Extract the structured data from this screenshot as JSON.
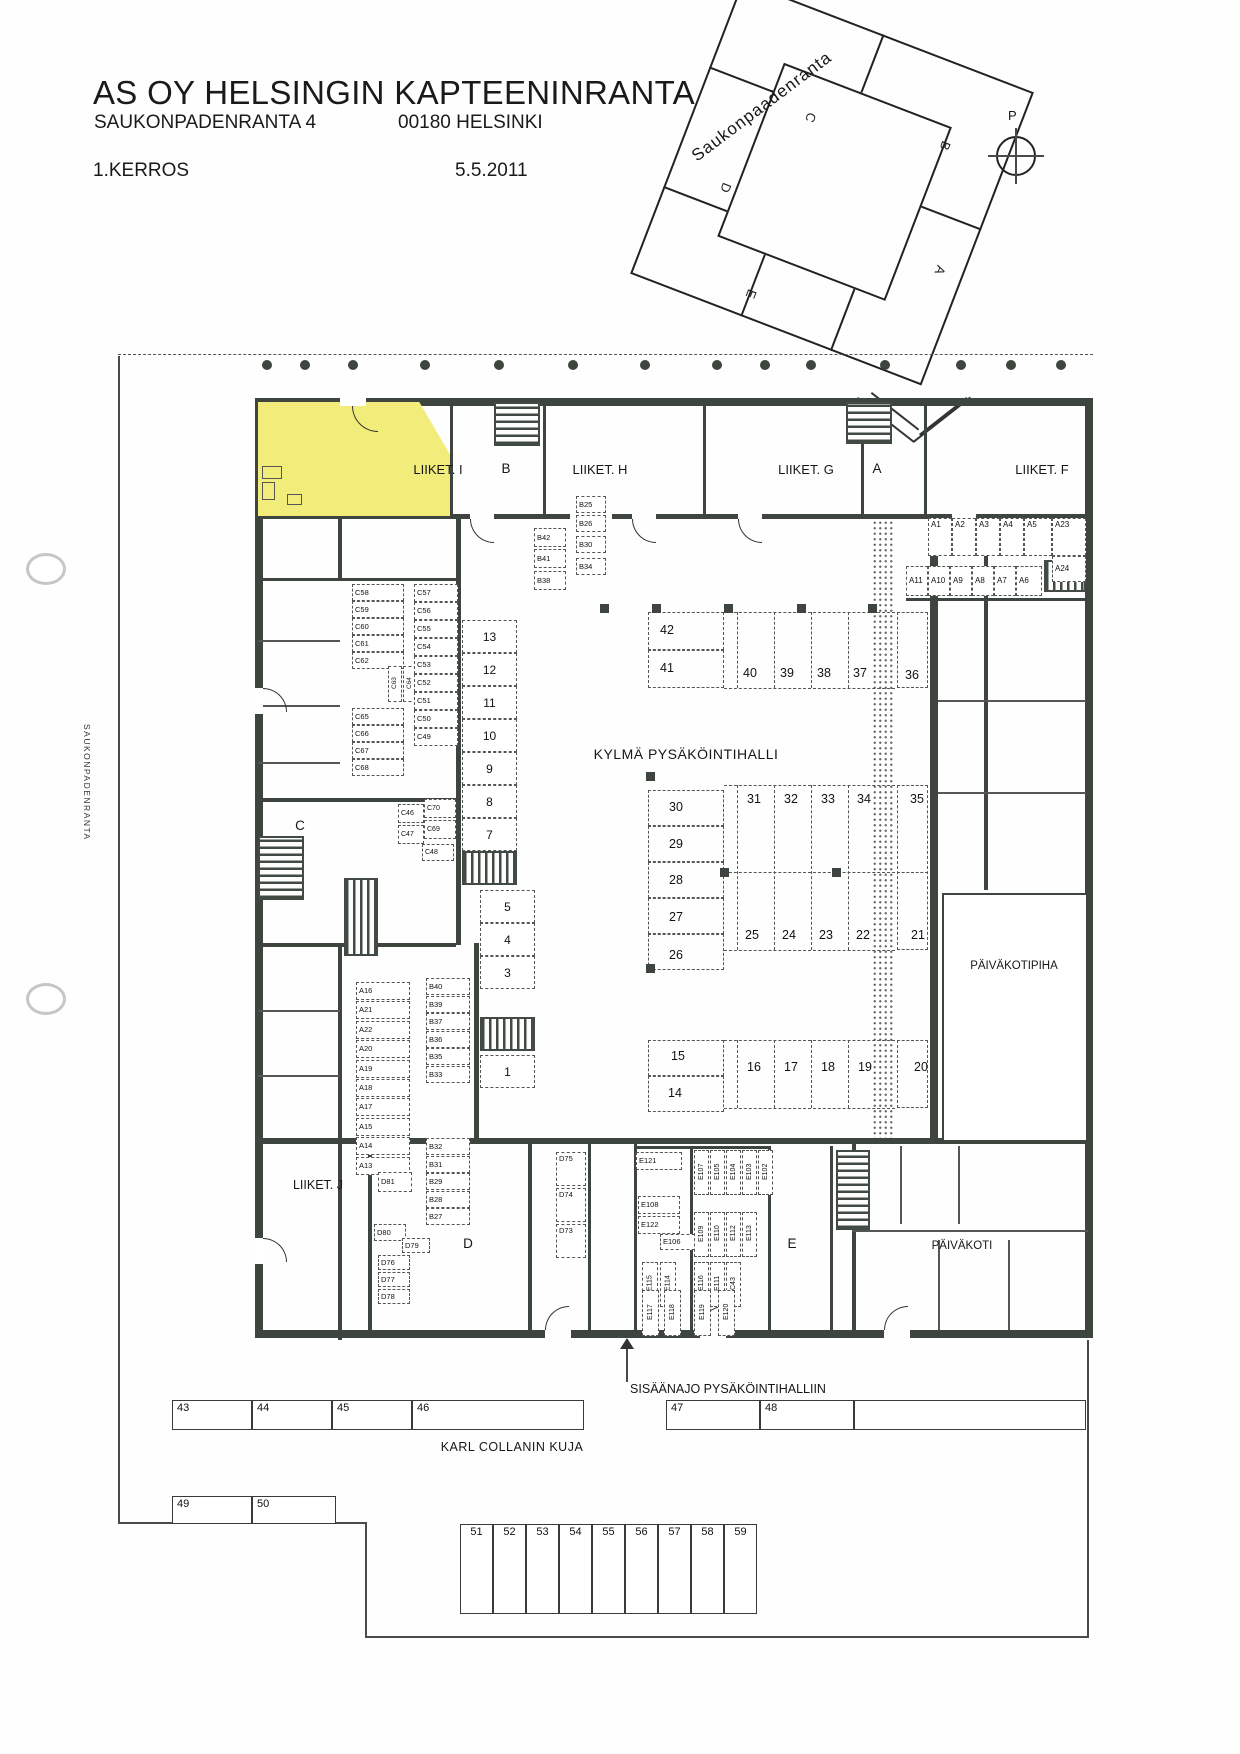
{
  "header": {
    "title": "AS OY HELSINGIN KAPTEENINRANTA",
    "address": "SAUKONPADENRANTA 4",
    "postal": "00180 HELSINKI",
    "floor": "1.KERROS",
    "date": "5.5.2011"
  },
  "site_map": {
    "street": "Saukonpaadenranta",
    "compass": "P",
    "wings": [
      "B",
      "C",
      "A",
      "D",
      "E"
    ]
  },
  "streets": {
    "west": "SAUKONPADENRANTA",
    "south": "KARL COLLANIN KUJA"
  },
  "plan": {
    "hall_label": "KYLMÄ PYSÄKÖINTIHALLI",
    "entrance_label": "SISÄÄNAJO PYSÄKÖINTIHALLIIN",
    "daycare": "PÄIVÄKOTI",
    "daycare_yard": "PÄIVÄKOTIPIHA",
    "retail_i": "LIIKET. I",
    "retail_h": "LIIKET. H",
    "retail_g": "LIIKET. G",
    "retail_f": "LIIKET. F",
    "retail_j": "LIIKET. J",
    "sec_a": "A",
    "sec_b": "B",
    "sec_c": "C",
    "sec_d": "D",
    "sec_e": "E"
  },
  "groups": {
    "c_left": [
      "C58",
      "C59",
      "C60",
      "C61",
      "C62"
    ],
    "c_rot": [
      "C63",
      "C64"
    ],
    "c_left2": [
      "C65",
      "C66",
      "C67",
      "C68"
    ],
    "c_right": [
      "C57",
      "C56",
      "C55",
      "C54",
      "C53",
      "C52",
      "C51",
      "C50",
      "C49"
    ],
    "c_small_left": [
      "C46",
      "C47"
    ],
    "c_small_48": [
      "C48"
    ],
    "c_small_right": [
      "C70",
      "C69"
    ],
    "stall_col": [
      "13",
      "12",
      "11",
      "10",
      "9",
      "8",
      "7"
    ],
    "stall_col2": [
      "5",
      "4",
      "3"
    ],
    "stall_col3": [
      "1"
    ],
    "p_42_41": [
      "42",
      "41"
    ],
    "p_top_row": [
      "40",
      "39",
      "38",
      "37"
    ],
    "p_36": [
      "36"
    ],
    "p_mid_col": [
      "30",
      "29",
      "28",
      "27",
      "26"
    ],
    "p_row31": [
      "31",
      "32",
      "33",
      "34"
    ],
    "p_35": [
      "35"
    ],
    "p_row25": [
      "25",
      "24",
      "23",
      "22"
    ],
    "p_21": [
      "21"
    ],
    "p_15_14": [
      "15",
      "14"
    ],
    "p_row16": [
      "16",
      "17",
      "18",
      "19"
    ],
    "p_20": [
      "20"
    ],
    "a_row1": [
      "A1",
      "A2",
      "A3",
      "A4",
      "A5",
      "A23"
    ],
    "a_24": [
      "A24"
    ],
    "a_row2": [
      "A11",
      "A10",
      "A9",
      "A8",
      "A7",
      "A6"
    ],
    "b_mid": [
      "B42",
      "B41",
      "B38"
    ],
    "b_right": [
      "B25",
      "B26",
      "B30",
      "B34"
    ],
    "a_col": [
      "A16",
      "A21",
      "A22",
      "A20",
      "A19",
      "A18",
      "A17",
      "A15",
      "A14",
      "A13"
    ],
    "b_col_u": [
      "B40",
      "B39",
      "B37",
      "B36",
      "B35",
      "B33"
    ],
    "b_col_l": [
      "B32",
      "B31",
      "B29",
      "B28",
      "B27"
    ],
    "d_cluster": [
      "D81",
      "D80",
      "D79",
      "D76",
      "D77",
      "D78"
    ],
    "d_col": [
      "D75",
      "D74",
      "D73"
    ],
    "e_h": [
      "E121",
      "E108",
      "E122",
      "E106"
    ],
    "e_v1": [
      "E107",
      "E105",
      "E104",
      "E103",
      "E102"
    ],
    "e_v2": [
      "E109",
      "E110",
      "E112",
      "E113"
    ],
    "e_v3": [
      "E115",
      "E114"
    ],
    "e_v4": [
      "E116",
      "E111",
      "C43"
    ],
    "e_v5": [
      "E117",
      "E118",
      "E119",
      "E120"
    ],
    "row_top": [
      "43",
      "44",
      "45",
      "46",
      "47",
      "48"
    ],
    "row_49": [
      "49",
      "50"
    ],
    "stalls_51": [
      "51",
      "52",
      "53",
      "54",
      "55",
      "56",
      "57",
      "58",
      "59"
    ]
  }
}
